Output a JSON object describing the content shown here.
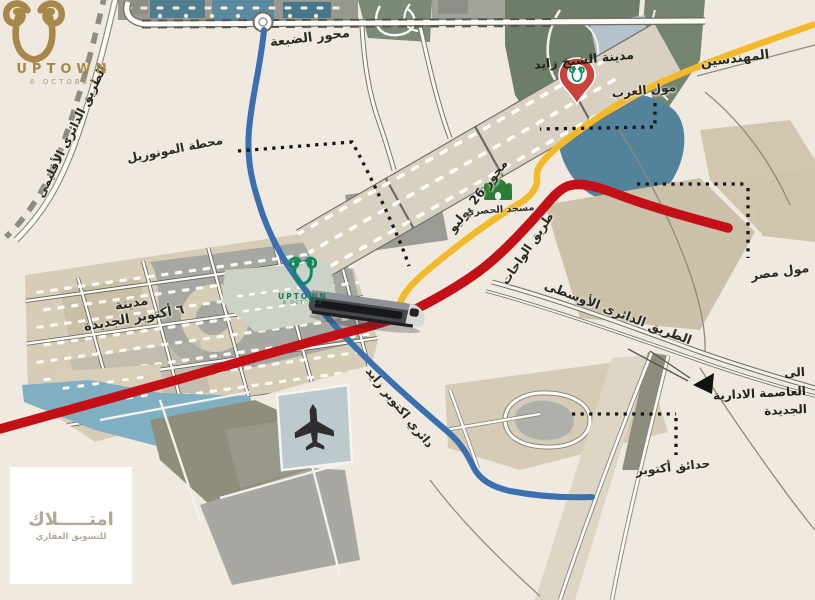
{
  "brand": {
    "name": "UPTOWN",
    "tagline": "6 OCTOBER"
  },
  "project_logo": {
    "name": "UPTOWN",
    "tagline": "6 OCTOBER"
  },
  "watermark": {
    "title": "امتـــــلاك",
    "subtitle": "للتسويق العقاري"
  },
  "roads": {
    "regional_ring": "الطريق الدائرى الأقليمى",
    "dabaa_axis": "محور الضبعة",
    "july_26_axis": "محور 26 يوليو",
    "wahat_road": "طريق الواحات",
    "middle_ring_road": "الطريق الدائرى الأوسطى",
    "october_zayed_ring": "دائري اكتوبر زايد"
  },
  "places": {
    "sheikh_zayed_city": "مدينة الشيخ زايد",
    "mohandessin": "المهندسين",
    "mall_of_arab": "مول العرب",
    "mall_of_egypt": "مول مصر",
    "hosary_mosque": "مسجد الحصري",
    "monorail_station": "محطة المونوريل",
    "new_october_city_line1": "مدينة",
    "new_october_city_line2": "٦ أكتوبر الجديدة",
    "october_gardens": "حدائق أكتوبر",
    "to_capital_line1": "الى",
    "to_capital_line2": "العاصمة الادارية",
    "to_capital_line3": "الجديدة"
  },
  "colors": {
    "map_background": "#efe9df",
    "yellow_road": "#f4b929",
    "red_road": "#c31017",
    "blue_road": "#3a6fb0",
    "brand_gold": "#a8874b",
    "project_green": "#0f8a60",
    "pin_red": "#c9423c"
  }
}
